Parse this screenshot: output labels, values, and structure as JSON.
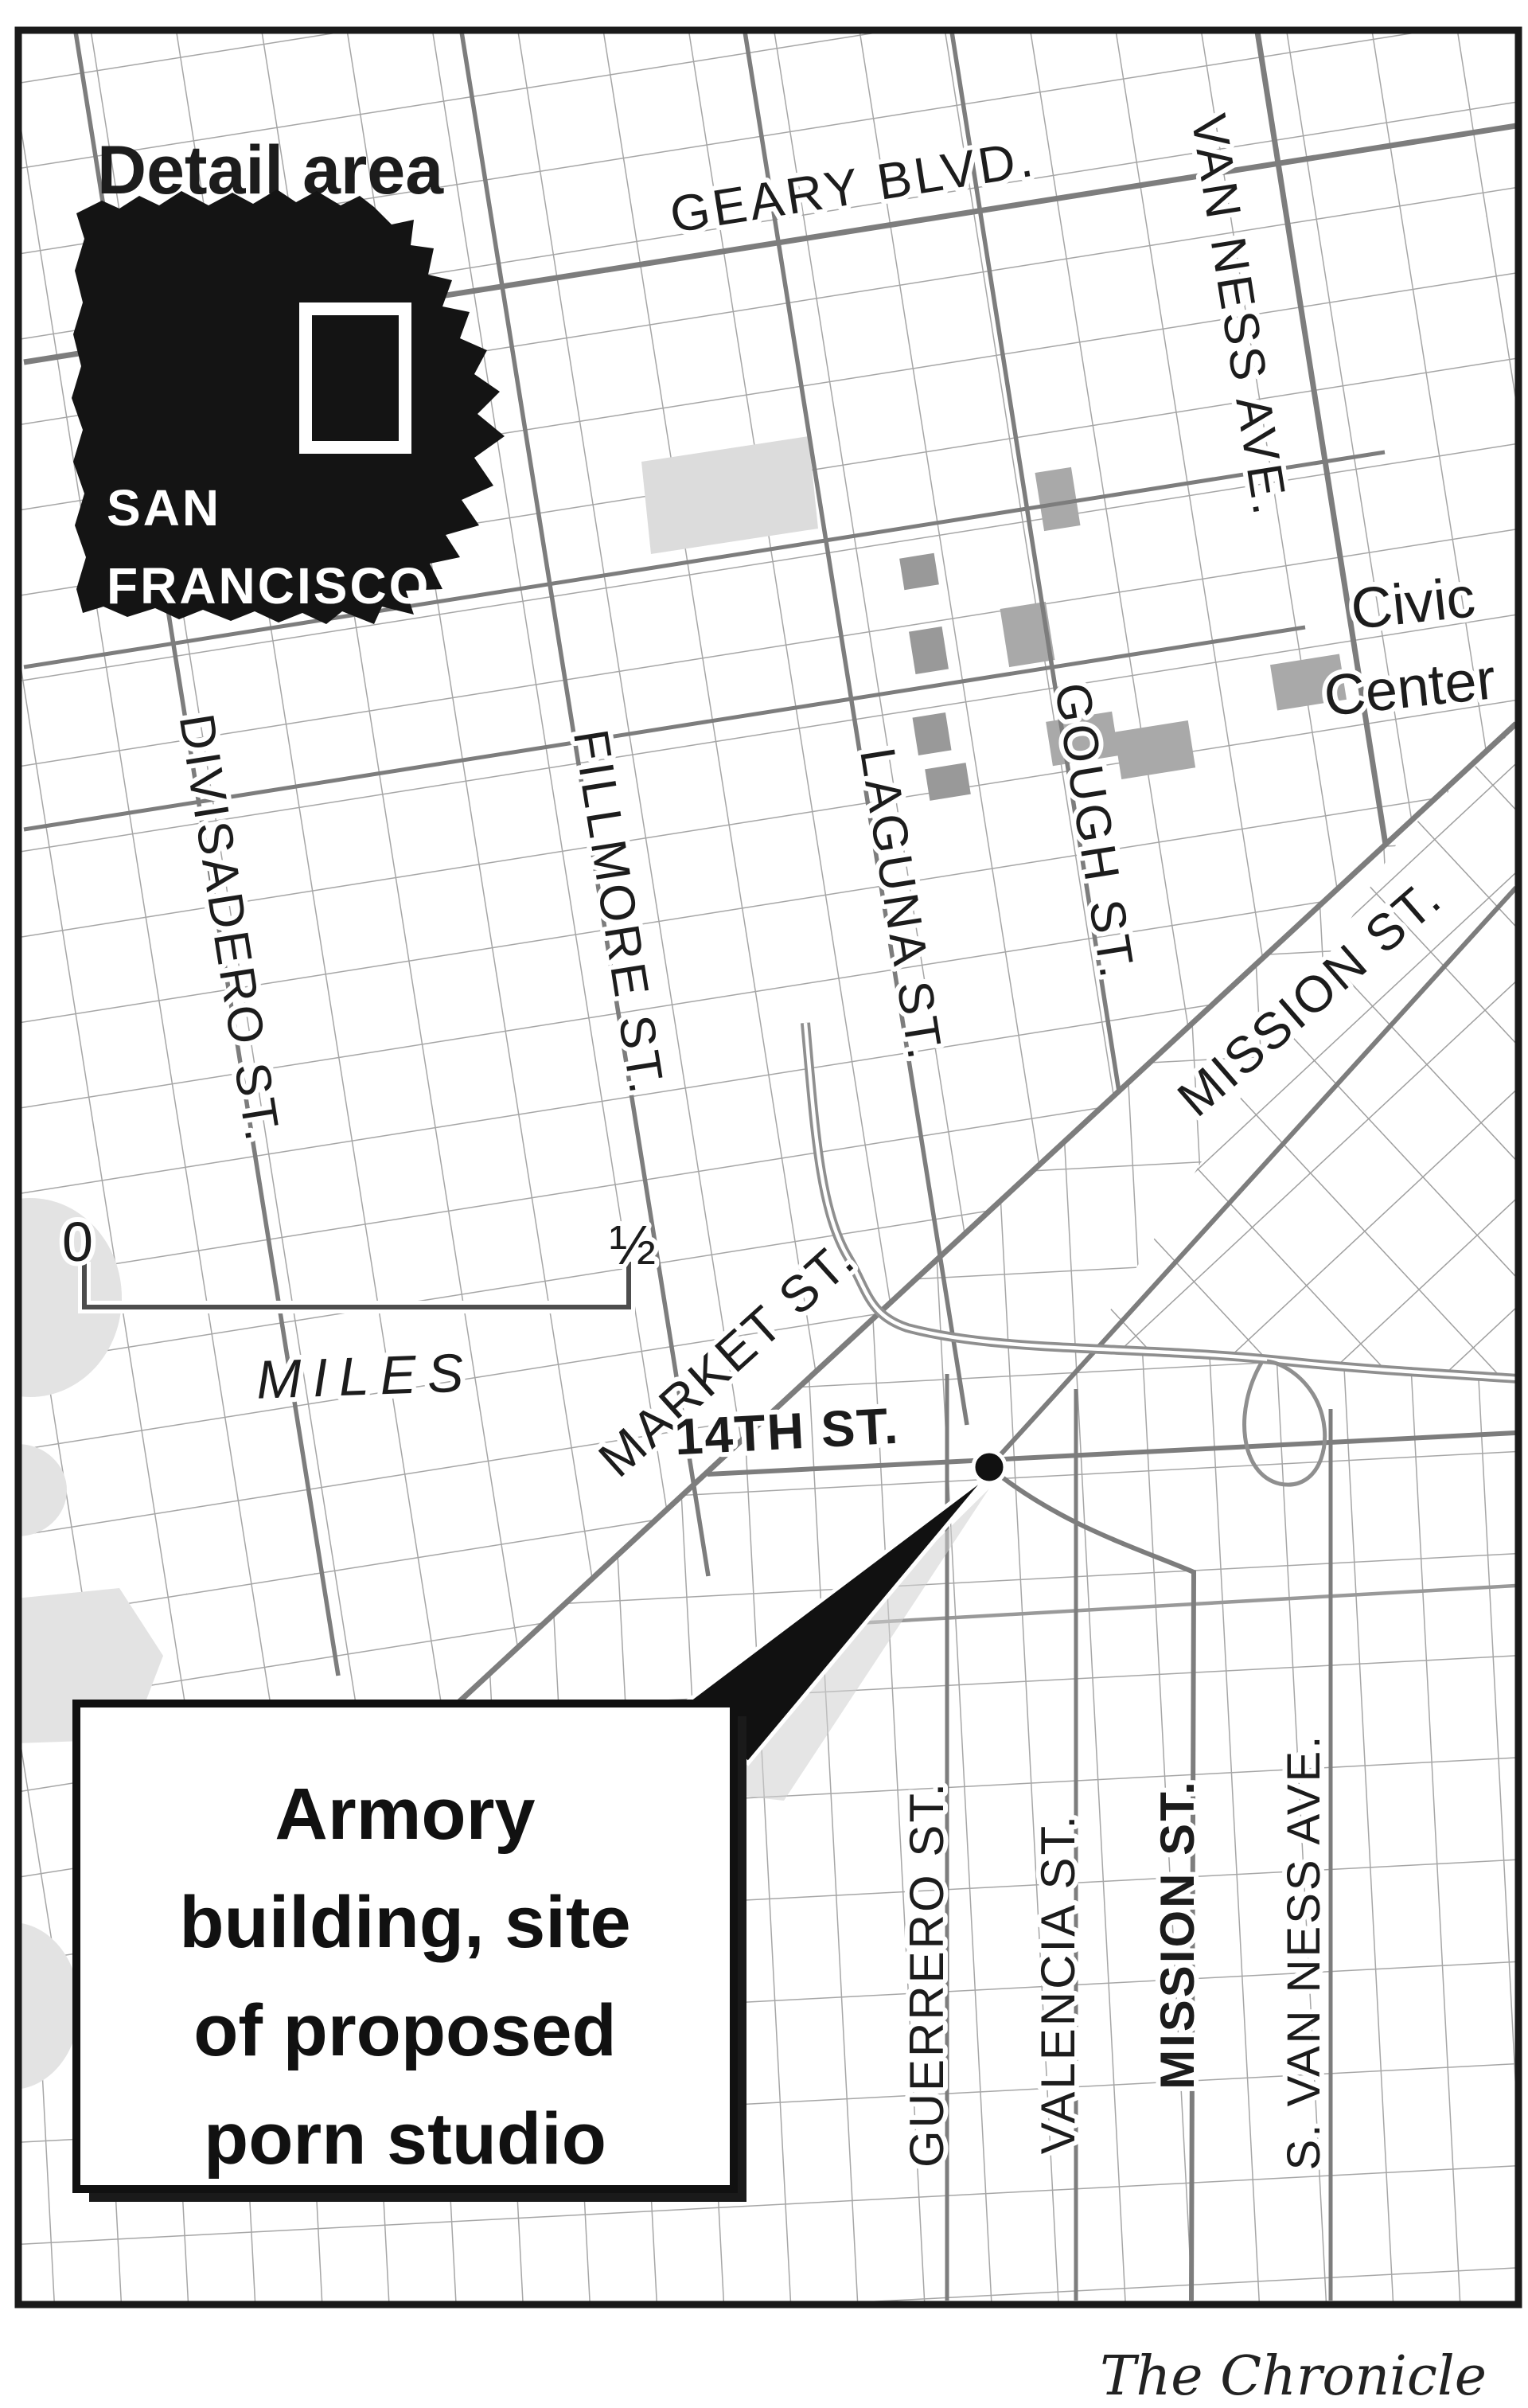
{
  "inset": {
    "title": "Detail area",
    "city_line1": "SAN",
    "city_line2": "FRANCISCO"
  },
  "streets": {
    "geary": "GEARY BLVD.",
    "van_ness": "VAN NESS AVE.",
    "divisadero": "DIVISADERO ST.",
    "fillmore": "FILLMORE ST.",
    "laguna": "LAGUNA ST.",
    "gough": "GOUGH ST.",
    "mission_diagonal": "MISSION ST.",
    "market": "MARKET ST.",
    "fourteenth": "14TH ST.",
    "guerrero": "GUERRERO ST.",
    "valencia": "VALENCIA ST.",
    "mission_south": "MISSION ST.",
    "s_van_ness": "S. VAN NESS AVE."
  },
  "places": {
    "civic_center_line1": "Civic",
    "civic_center_line2": "Center"
  },
  "scale": {
    "zero": "0",
    "half": "½",
    "unit": "MILES"
  },
  "callout": {
    "lines": [
      "Armory",
      "building, site",
      "of proposed",
      "porn studio"
    ],
    "full_text": "Armory building, site of proposed porn studio"
  },
  "credit": "The Chronicle",
  "colors": {
    "road_minor": "#a6a6a6",
    "road_major": "#7d7d7d",
    "freeway": "#8f8f8f",
    "building_gray": "#a9a9a9",
    "block_light": "#dcdcdc",
    "park": "#e3e3e3",
    "ink": "#111111",
    "frame": "#1a1a1a"
  }
}
